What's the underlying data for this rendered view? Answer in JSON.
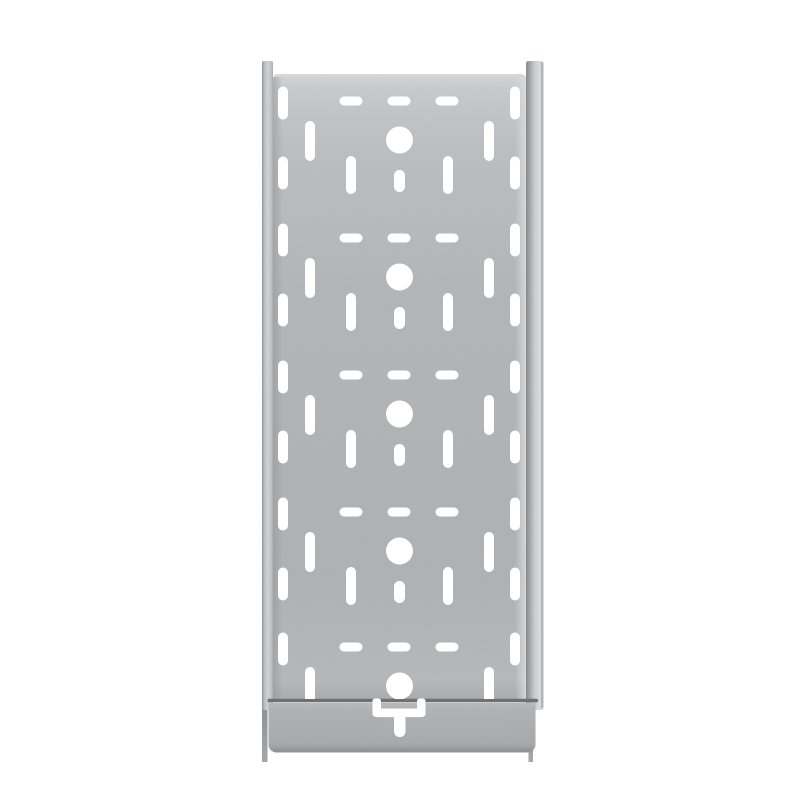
{
  "scene": {
    "type": "product-photo",
    "subject": "perforated-galvanized-steel-cable-tray-vertical",
    "background_color": "#ffffff"
  },
  "palette": {
    "background": "#ffffff",
    "hole_white": "#ffffff",
    "plate_mid": "#b2b5b7",
    "plate_top_light": "#c7cacc",
    "rail_dark_edge": "#84878a",
    "rail_light": "#d9dcde",
    "seam_dark": "#6b6e70",
    "coupling_gray": "#a7aaac",
    "coupling_bottom_edge": "#8f9294",
    "leg_gray": "#8b8e90"
  },
  "viewport": {
    "width": 800,
    "height": 800
  },
  "gradients": [
    {
      "id": "gLeftRail",
      "dir": "h",
      "stops": [
        [
          0,
          "#898c8e",
          1
        ],
        [
          0.18,
          "#b7babc",
          1
        ],
        [
          0.5,
          "#d0d3d5",
          1
        ],
        [
          0.8,
          "#c3c6c8",
          1
        ],
        [
          1,
          "#a9acae",
          1
        ]
      ]
    },
    {
      "id": "gRightRail",
      "dir": "h",
      "stops": [
        [
          0,
          "#84878a",
          1
        ],
        [
          0.18,
          "#9ea1a3",
          1
        ],
        [
          0.5,
          "#cbced0",
          1
        ],
        [
          0.78,
          "#d9dcde",
          1
        ],
        [
          0.93,
          "#ced1d3",
          1
        ],
        [
          1,
          "#aeb1b3",
          1
        ]
      ]
    },
    {
      "id": "gPlate",
      "dir": "v",
      "stops": [
        [
          0,
          "#d4d7d9",
          1
        ],
        [
          0.025,
          "#c7cacc",
          1
        ],
        [
          0.12,
          "#bbbec0",
          1
        ],
        [
          0.35,
          "#b2b5b7",
          1
        ],
        [
          0.8,
          "#aeb1b3",
          1
        ],
        [
          0.97,
          "#b5b8ba",
          1
        ],
        [
          1,
          "#a9acae",
          1
        ]
      ]
    },
    {
      "id": "gCoupling",
      "dir": "v",
      "stops": [
        [
          0,
          "#b7babc",
          1
        ],
        [
          0.15,
          "#afb2b4",
          1
        ],
        [
          0.8,
          "#a7aaac",
          1
        ],
        [
          0.93,
          "#9a9d9f",
          1
        ],
        [
          1,
          "#8b8e90",
          1
        ]
      ]
    },
    {
      "id": "gLeg",
      "dir": "v",
      "stops": [
        [
          0,
          "#8b8e90",
          1
        ],
        [
          1,
          "#a5a8aa",
          1
        ]
      ]
    },
    {
      "id": "gFoldL",
      "dir": "h",
      "stops": [
        [
          0,
          "#8e9193",
          0.5
        ],
        [
          1,
          "#8e9193",
          0
        ]
      ]
    },
    {
      "id": "gFoldR",
      "dir": "h",
      "stops": [
        [
          0,
          "#dcdfe1",
          0
        ],
        [
          1,
          "#dcdfe1",
          0.85
        ]
      ]
    }
  ],
  "grain": {
    "baseFrequency": 0.8,
    "numOctaves": 2,
    "seed": 11,
    "opacity": 0.085
  },
  "clips": {
    "plateClip": [
      {
        "x": 273,
        "y": 74,
        "w": 253,
        "h": 625
      }
    ],
    "silhouetteClip": [
      {
        "x": 262,
        "y": 61,
        "w": 11,
        "h": 649
      },
      {
        "x": 526,
        "y": 61,
        "w": 17.5,
        "h": 649
      },
      {
        "x": 273,
        "y": 74,
        "w": 253,
        "h": 625
      },
      {
        "x": 268,
        "y": 699,
        "w": 268,
        "h": 53
      }
    ]
  },
  "shapes": [
    {
      "t": "rect",
      "n": "background",
      "i": false,
      "x": 0,
      "y": 0,
      "w": 800,
      "h": 800,
      "f": "#ffffff"
    },
    {
      "t": "rect",
      "n": "coupling-side-edge-left",
      "i": false,
      "x": 262,
      "y": 700,
      "w": 5.5,
      "h": 62,
      "f": "url(#gLeg)"
    },
    {
      "t": "rect",
      "n": "coupling-side-edge-right",
      "i": false,
      "x": 528.5,
      "y": 700,
      "w": 4.5,
      "h": 62,
      "f": "url(#gLeg)"
    },
    {
      "t": "rect",
      "n": "side-rail-left",
      "i": false,
      "x": 262,
      "y": 61,
      "w": 11,
      "h": 649,
      "rx": 2,
      "f": "url(#gLeftRail)"
    },
    {
      "t": "rect",
      "n": "side-rail-right",
      "i": false,
      "x": 526,
      "y": 61,
      "w": 17.5,
      "h": 649,
      "rx": 2.5,
      "f": "url(#gRightRail)"
    },
    {
      "t": "rect",
      "n": "side-rail-right-outer-edge",
      "i": false,
      "x": 541,
      "y": 62,
      "w": 1.8,
      "h": 646,
      "f": "#9a9da0",
      "o": 0.55
    },
    {
      "t": "path",
      "n": "base-plate",
      "i": false,
      "d": "M273,80 q0,-6 6,-6 h241 q6,0 6,6 v619 h-253 z",
      "f": "url(#gPlate)"
    },
    {
      "t": "rect",
      "n": "plate-top-edge-highlight",
      "i": false,
      "x": 277,
      "y": 74.5,
      "w": 244,
      "h": 2.2,
      "rx": 1,
      "f": "#d8dbdd",
      "o": 0.9
    },
    {
      "t": "rect",
      "n": "plate-left-fold-shadow",
      "i": false,
      "x": 273,
      "y": 77,
      "w": 10,
      "h": 622,
      "f": "url(#gFoldL)"
    },
    {
      "t": "rect",
      "n": "plate-right-fold-highlight",
      "i": false,
      "x": 515,
      "y": 77,
      "w": 11,
      "h": 622,
      "f": "url(#gFoldR)"
    },
    {
      "t": "rect",
      "n": "coupling-seam-line",
      "i": false,
      "x": 267.5,
      "y": 698.8,
      "w": 270.5,
      "h": 3.4,
      "rx": 1.6,
      "f": "#6b6e70"
    },
    {
      "t": "rect",
      "n": "coupling-seam-underlight",
      "i": false,
      "x": 270,
      "y": 702.4,
      "w": 264,
      "h": 2,
      "f": "#c5c8ca",
      "o": 0.5
    },
    {
      "t": "path",
      "n": "coupling-plate",
      "i": false,
      "d": "M268.5,703 h267 v41.5 a8,8 0 0 1 -8,8 h-251 a8,8 0 0 1 -8,-8 z",
      "f": "url(#gCoupling)"
    },
    {
      "t": "rect",
      "n": "coupling-bottom-edge",
      "i": false,
      "x": 273,
      "y": 748.5,
      "w": 258,
      "h": 2.8,
      "rx": 1.4,
      "f": "#8f9294",
      "o": 0.65
    },
    {
      "t": "grain",
      "n": "galvanized-texture",
      "i": false,
      "x": 260,
      "y": 59,
      "w": 286,
      "h": 697
    },
    {
      "t": "perforations",
      "n": "perforation-field",
      "i": false
    },
    {
      "t": "rect",
      "n": "bracket-cutout-left-arm",
      "i": false,
      "x": 372.5,
      "y": 698.5,
      "w": 8.5,
      "h": 18,
      "rx": 2.5,
      "f": "#ffffff"
    },
    {
      "t": "rect",
      "n": "bracket-cutout-right-arm",
      "i": false,
      "x": 417,
      "y": 698.5,
      "w": 8.5,
      "h": 18,
      "rx": 2.5,
      "f": "#ffffff"
    },
    {
      "t": "rect",
      "n": "bracket-cutout-bar",
      "i": false,
      "x": 372.5,
      "y": 708.5,
      "w": 53,
      "h": 8.6,
      "rx": 4,
      "f": "#ffffff"
    },
    {
      "t": "rect",
      "n": "bracket-cutout-tail",
      "i": false,
      "x": 394,
      "y": 711,
      "w": 11.5,
      "h": 26,
      "rx": 5.5,
      "f": "#ffffff"
    }
  ],
  "pattern": {
    "clip": "plateClip",
    "fill": "#ffffff",
    "center_x": 399.5,
    "unit_centers_y": [
      140,
      277,
      414,
      551,
      686
    ],
    "circle": {
      "r": 13.5
    },
    "h_slots": {
      "dy": -39,
      "xs": [
        351,
        399,
        447
      ],
      "w": 23,
      "h": 9
    },
    "mid_slots_a": {
      "xs": [
        310,
        489
      ],
      "dy": 1,
      "w": 10,
      "h": 40
    },
    "mid_slots_b": {
      "xs": [
        351,
        448
      ],
      "dy": 35,
      "w": 10,
      "h": 38,
      "skip_last": true
    },
    "small_slot": {
      "dy": 41,
      "w": 11,
      "h": 22,
      "skip_last": true
    },
    "edge_slots": {
      "xs": [
        283,
        515
      ],
      "dys": [
        -37,
        33
      ],
      "w": 10,
      "h": 33
    }
  }
}
